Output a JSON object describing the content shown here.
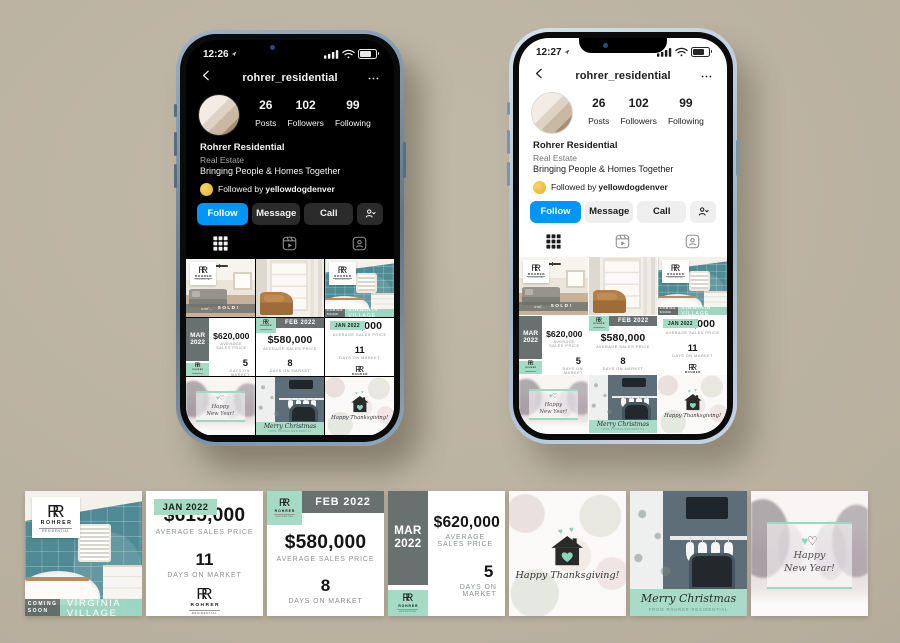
{
  "page": {
    "background": "#bdb4a3"
  },
  "phone_left": {
    "time": "12:26"
  },
  "phone_right": {
    "time": "12:27"
  },
  "ig": {
    "header": {
      "username": "rohrer_residential"
    },
    "stats": {
      "posts": {
        "value": "26",
        "label": "Posts"
      },
      "followers": {
        "value": "102",
        "label": "Followers"
      },
      "following": {
        "value": "99",
        "label": "Following"
      }
    },
    "profile": {
      "name": "Rohrer Residential",
      "category": "Real Estate",
      "bio": "Bringing People & Homes Together",
      "followed_by_prefix": "Followed by",
      "followed_by_account": "yellowdogdenver"
    },
    "actions": {
      "follow": "Follow",
      "message": "Message",
      "call": "Call"
    }
  },
  "posts": {
    "sold": {
      "prefix": "and...",
      "label": "SOLD!"
    },
    "virginia": {
      "coming_line1": "COMING",
      "coming_line2": "SOON",
      "location": "VIRGINIA VILLAGE"
    },
    "jan": {
      "month": "JAN 2022",
      "price": "$615,000",
      "price_label": "AVERAGE SALES PRICE",
      "days": "11",
      "days_label": "DAYS ON MARKET"
    },
    "feb": {
      "month": "FEB 2022",
      "price": "$580,000",
      "price_label": "AVERAGE SALES PRICE",
      "days": "8",
      "days_label": "DAYS ON MARKET"
    },
    "mar": {
      "month_line1": "MAR",
      "month_line2": "2022",
      "price": "$620,000",
      "price_label": "AVERAGE SALES PRICE",
      "days": "5",
      "days_label": "DAYS ON MARKET"
    },
    "thanksgiving": {
      "greeting": "Happy Thanksgiving!"
    },
    "christmas": {
      "greeting": "Merry Christmas",
      "subtext": "FROM ROHRER RESIDENTIAL"
    },
    "newyear": {
      "greeting": "Happy New Year!"
    }
  },
  "logo": {
    "monogram": "RR",
    "name": "ROHRER",
    "subtitle": "RESIDENTIAL"
  },
  "icons": {
    "hearts": "♥ ♥",
    "heart_filled": "♥",
    "heart_outline": "♡"
  },
  "colors": {
    "mint": "#a5dac5",
    "slate": "#6b7170",
    "instagram_blue": "#0095f6",
    "highlight_yellow": "#e8b63a"
  }
}
